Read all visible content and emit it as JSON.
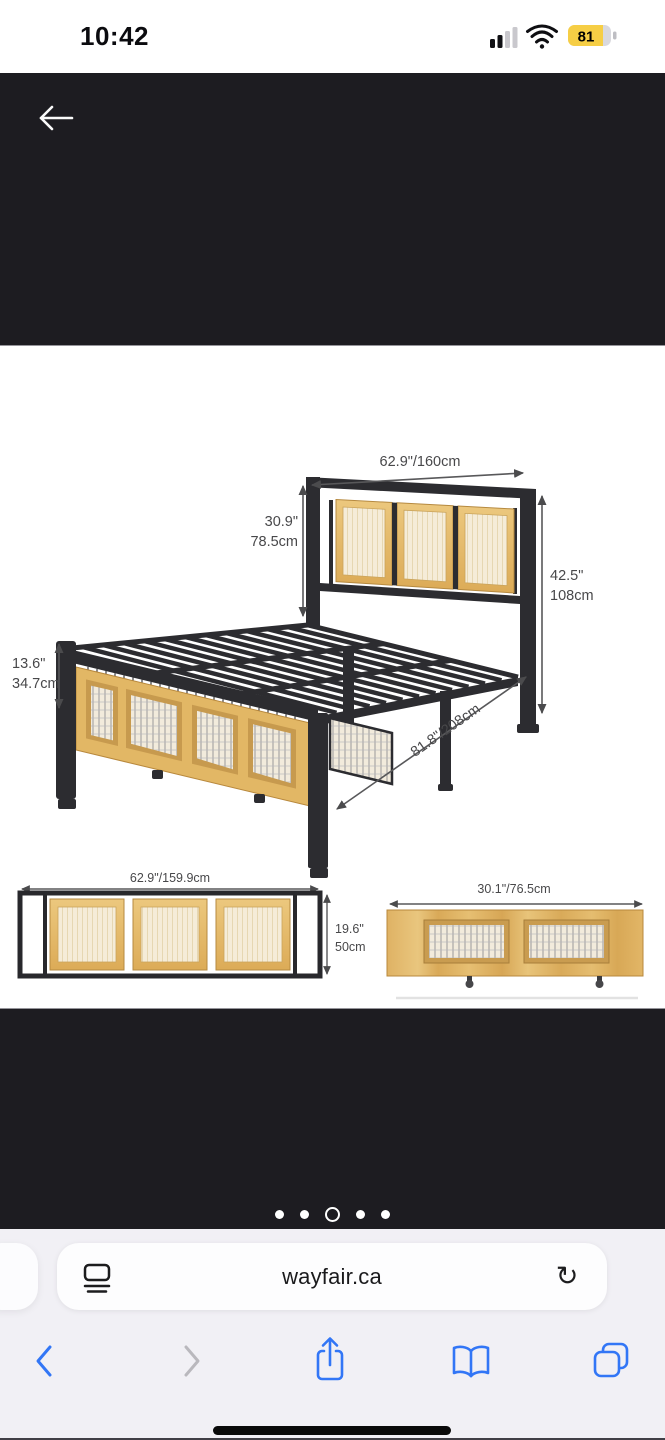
{
  "status_bar": {
    "time": "10:42",
    "battery_percent": "81",
    "signal_icon": "cellular-signal-2-of-4-bars",
    "wifi_icon": "wifi-full"
  },
  "photo_viewer": {
    "back_icon": "arrow-left",
    "carousel": {
      "dot_count": 5,
      "active_index": 2
    }
  },
  "product_diagram": {
    "main_view": {
      "headboard_width": "62.9\"/160cm",
      "headboard_panel_height_in": "30.9\"",
      "headboard_panel_height_cm": "78.5cm",
      "headboard_total_height_in": "42.5\"",
      "headboard_total_height_cm": "108cm",
      "footboard_height_in": "13.6\"",
      "footboard_height_cm": "34.7cm",
      "bed_length": "81.8\"/208cm"
    },
    "headboard_front_view": {
      "width": "62.9\"/159.9cm",
      "height_in": "19.6\"",
      "height_cm": "50cm"
    },
    "drawer_front_view": {
      "width": "30.1\"/76.5cm"
    }
  },
  "browser": {
    "address_bar": {
      "url": "wayfair.ca",
      "page_menu_icon": "page-format",
      "reload_icon": "reload",
      "reload_glyph": "↻"
    },
    "toolbar": {
      "back_icon": "chevron-back",
      "forward_icon": "chevron-forward",
      "share_icon": "share-square-arrow-up",
      "bookmarks_icon": "open-book",
      "tabs_icon": "two-overlapping-squares"
    }
  },
  "colors": {
    "accent_blue": "#3276f6",
    "disabled_gray": "#b9b8bd",
    "photo_background": "#1d1c21",
    "battery_yellow": "#f6ce45",
    "metal_black": "#2c2c30",
    "wood": "#e2b765",
    "cane": "#f3ead2"
  }
}
